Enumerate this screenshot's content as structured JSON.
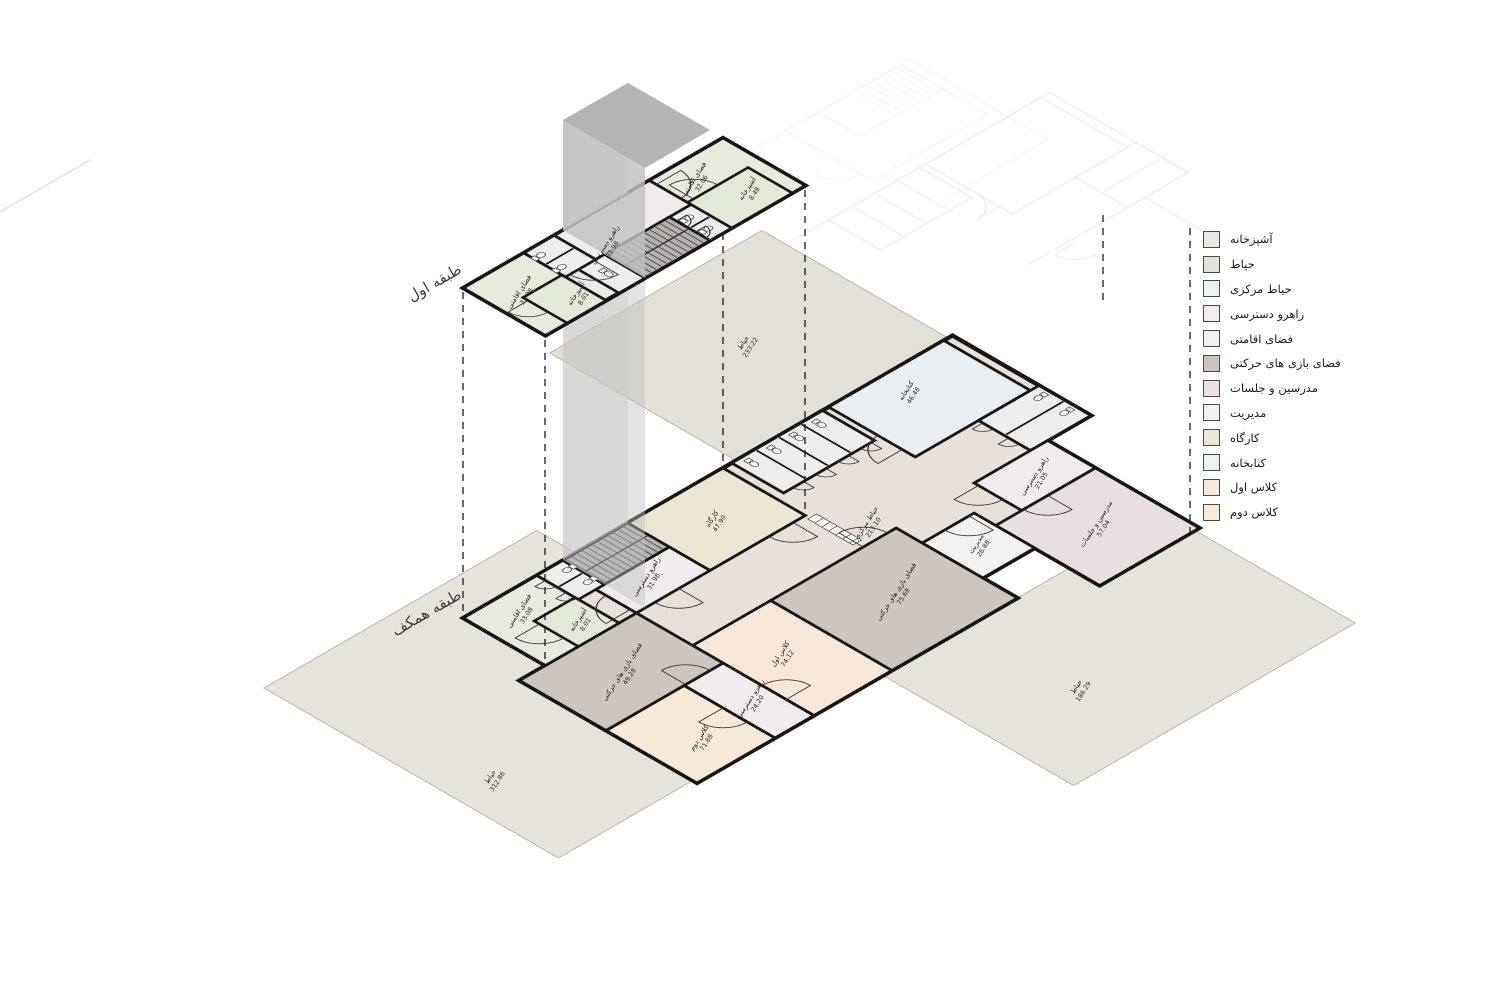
{
  "legend": {
    "items": [
      {
        "label": "آشپزخانه",
        "color": "#e7ebdf"
      },
      {
        "label": "حیاط",
        "color": "#e0e4d8"
      },
      {
        "label": "حیاط مرکزی",
        "color": "#eef1f2"
      },
      {
        "label": "راهرو دسترسی",
        "color": "#f3edf0"
      },
      {
        "label": "فضای اقامتی",
        "color": "#f1f1ee"
      },
      {
        "label": "فضای بازی های حرکتی",
        "color": "#cbc4c0"
      },
      {
        "label": "مدرسین و جلسات",
        "color": "#eae0e0"
      },
      {
        "label": "مدیریت",
        "color": "#f4f2f0"
      },
      {
        "label": "کارگاه",
        "color": "#ebe7d6"
      },
      {
        "label": "کتابخانه",
        "color": "#edf1f4"
      },
      {
        "label": "کلاس اول",
        "color": "#f7e8dd"
      },
      {
        "label": "کلاس دوم",
        "color": "#f8ecda"
      }
    ]
  },
  "floors": {
    "first": "طبقه اول",
    "ground": "طبقه همکف"
  },
  "rooms": {
    "f_res1": {
      "name": "فضای اقامتی",
      "area": "32.06"
    },
    "f_kitchen1": {
      "name": "آشپزخانه",
      "area": "8.48"
    },
    "f_corridor": {
      "name": "راهرو دسترسی",
      "area": "31.98"
    },
    "f_res2": {
      "name": "فضای اقامتی",
      "area": "33.08"
    },
    "f_kitchen2": {
      "name": "آشپزخانه",
      "area": "8.01"
    },
    "g_workshop": {
      "name": "کارگاه",
      "area": "47.90"
    },
    "g_corridor1": {
      "name": "راهرو دسترسی",
      "area": "31.98"
    },
    "g_res": {
      "name": "فضای اقامتی",
      "area": "33.08"
    },
    "g_kitchen": {
      "name": "آشپزخانه",
      "area": "8.01"
    },
    "g_library": {
      "name": "کتابخانه",
      "area": "46.48"
    },
    "g_central": {
      "name": "حیاط مرکزی",
      "area": "213.10"
    },
    "g_corridor2": {
      "name": "راهرو دسترسی",
      "area": "21.05"
    },
    "g_teachers": {
      "name": "مدرسین و جلسات",
      "area": "57.04"
    },
    "g_admin": {
      "name": "مدیریت",
      "area": "26.88"
    },
    "g_play1": {
      "name": "فضای بازی های حرکتی",
      "area": "75.68"
    },
    "g_class1": {
      "name": "کلاس اول",
      "area": "74.12"
    },
    "g_corridor3": {
      "name": "راهرو دسترسی",
      "area": "24.20"
    },
    "g_class2": {
      "name": "کلاس دوم",
      "area": "71.88"
    },
    "g_play2": {
      "name": "فضای بازی های حرکتی",
      "area": "49.28"
    },
    "yard_top": {
      "name": "حیاط",
      "area": "233.22"
    },
    "yard_left": {
      "name": "حیاط",
      "area": "312.86"
    },
    "yard_right": {
      "name": "حیاط",
      "area": "186.29"
    }
  },
  "colors": {
    "residential": "#e6ebde",
    "kitchen": "#e3e9d9",
    "corridor": "#f1ebee",
    "stairs": "#b5b1ae",
    "toilet": "#efedeb",
    "workshop": "#eae6d3",
    "library": "#e9eef2",
    "spine": "#e7e1da",
    "teachers": "#e9dfe0",
    "admin": "#f3f1ef",
    "play": "#ccc5c0",
    "class1": "#f7e7da",
    "class2": "#f7e9d8",
    "yard": "#e6e3dc",
    "yard_top": "#e3e0d7",
    "tower_light": "#d6d5d4",
    "tower_mid": "#c2c1c0",
    "tower_top": "#b1b0af",
    "wall": "#161616"
  }
}
